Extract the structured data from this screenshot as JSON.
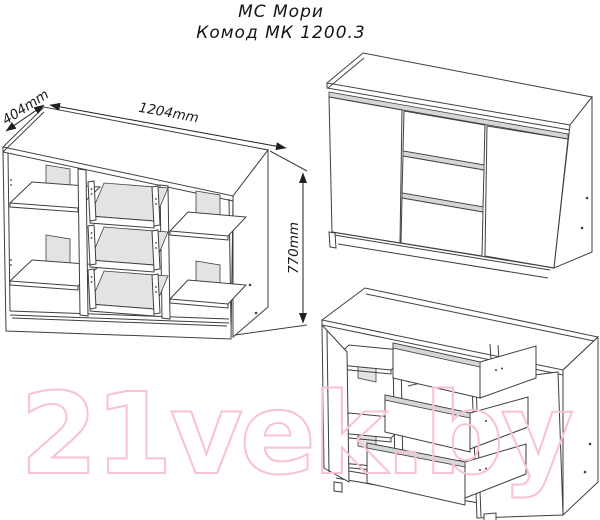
{
  "title": {
    "line1": "МС Мори",
    "line2": "Комод МК 1200.3"
  },
  "dimensions": {
    "depth_label": "404mm",
    "width_label": "1204mm",
    "height_label": "770mm"
  },
  "watermark": {
    "text": "21vek.by",
    "color": "#f8c2ce"
  },
  "colors": {
    "line": "#3f3f3f",
    "back_panel_gray": "#e3e3e3",
    "groove_gray": "#d6d6d6",
    "background": "#ffffff"
  }
}
